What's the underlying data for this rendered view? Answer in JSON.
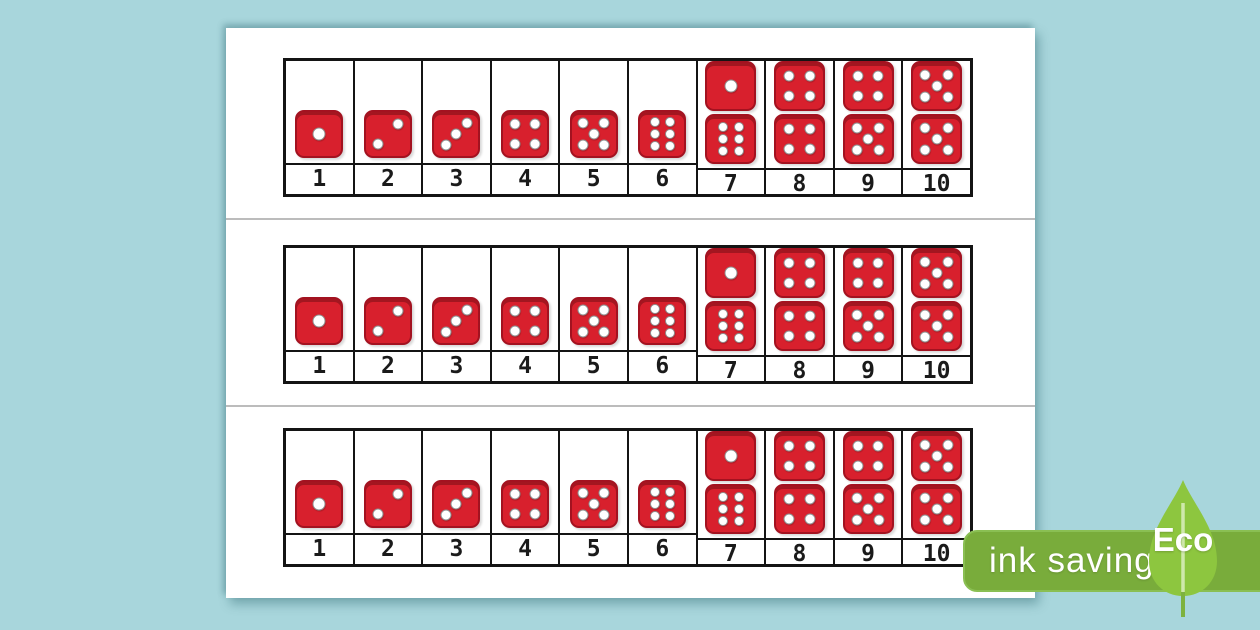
{
  "colors": {
    "background": "#a8d6dc",
    "paper": "#ffffff",
    "die_red": "#d8202d",
    "die_border": "#a31220",
    "pip_white": "#ffffff",
    "table_border": "#141414",
    "cut_line": "#bcbcbc",
    "number_color": "#1a1a1a",
    "badge_green": "#79ac3b",
    "leaf_green": "#8dc63f",
    "leaf_stem": "#cfe8ab"
  },
  "track": {
    "strip_count": 3,
    "cells": [
      {
        "label": "1",
        "dice": [
          1
        ]
      },
      {
        "label": "2",
        "dice": [
          2
        ]
      },
      {
        "label": "3",
        "dice": [
          3
        ]
      },
      {
        "label": "4",
        "dice": [
          4
        ]
      },
      {
        "label": "5",
        "dice": [
          5
        ]
      },
      {
        "label": "6",
        "dice": [
          6
        ]
      },
      {
        "label": "7",
        "dice": [
          1,
          6
        ]
      },
      {
        "label": "8",
        "dice": [
          4,
          4
        ]
      },
      {
        "label": "9",
        "dice": [
          4,
          5
        ]
      },
      {
        "label": "10",
        "dice": [
          5,
          5
        ]
      }
    ]
  },
  "eco_badge": {
    "label": "ink saving",
    "leaf_label": "Eco"
  }
}
